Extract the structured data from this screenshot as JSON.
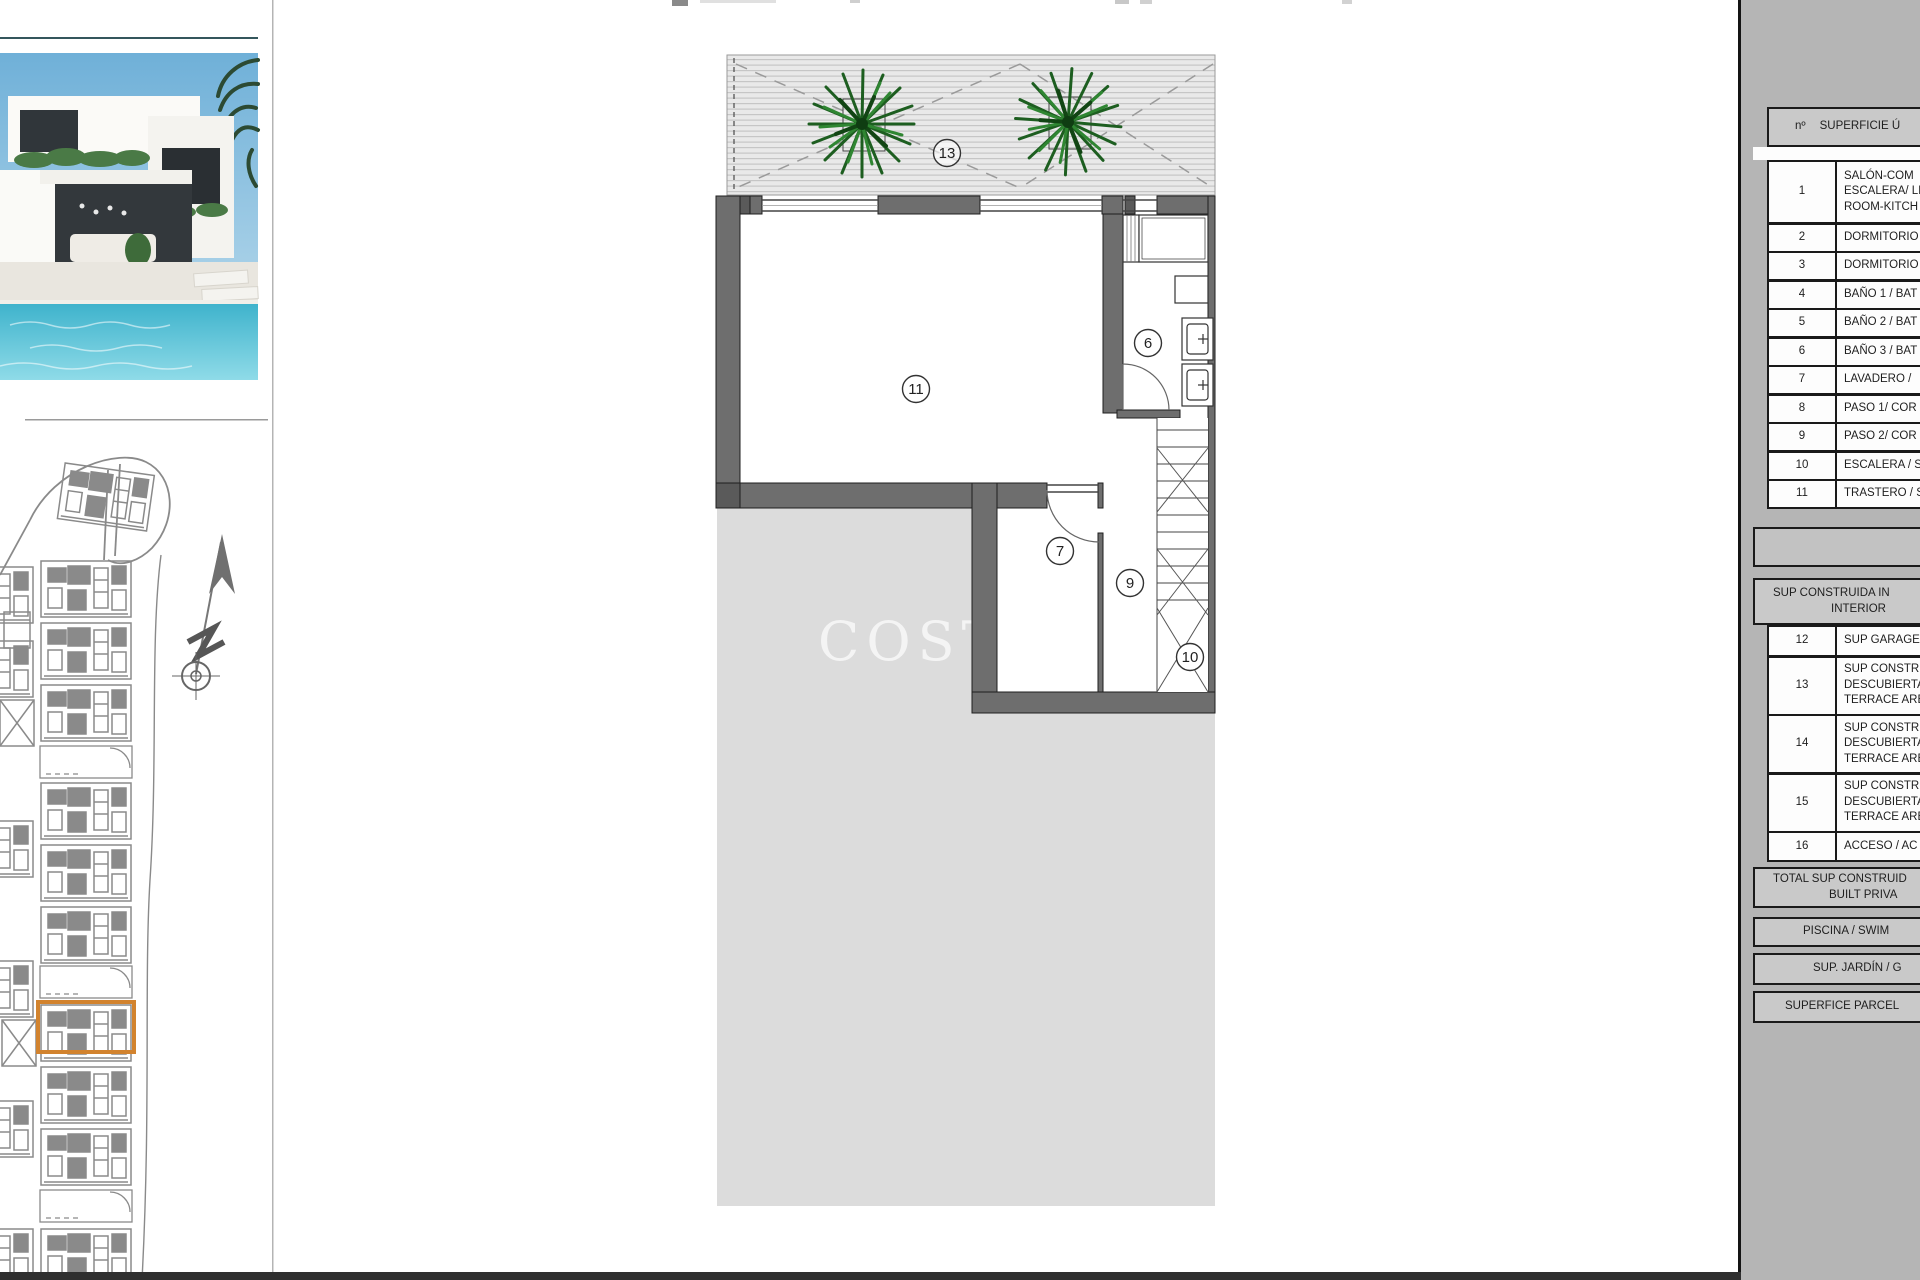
{
  "watermark": {
    "main": "COSTA",
    "tail": "s"
  },
  "floor_plan": {
    "labels": {
      "terrace": "13",
      "storage": "11",
      "bath": "6",
      "laundry": "7",
      "hall": "9",
      "stairs": "10"
    }
  },
  "right_panel": {
    "header": {
      "num": "nº",
      "title": "SUPERFICIE Ú"
    },
    "rows": [
      {
        "n": "1",
        "lines": [
          "SALÓN-COM",
          "ESCALERA/ LI",
          "ROOM-KITCH"
        ]
      },
      {
        "n": "2",
        "lines": [
          "DORMITORIO"
        ]
      },
      {
        "n": "3",
        "lines": [
          "DORMITORIO"
        ]
      },
      {
        "n": "4",
        "lines": [
          "BAÑO 1 / BAT"
        ]
      },
      {
        "n": "5",
        "lines": [
          "BAÑO 2 / BAT"
        ]
      },
      {
        "n": "6",
        "lines": [
          "BAÑO 3 / BAT"
        ]
      },
      {
        "n": "7",
        "lines": [
          "LAVADERO /"
        ]
      },
      {
        "n": "8",
        "lines": [
          "PASO 1/ COR"
        ]
      },
      {
        "n": "9",
        "lines": [
          "PASO 2/ COR"
        ]
      },
      {
        "n": "10",
        "lines": [
          "ESCALERA / S"
        ]
      },
      {
        "n": "11",
        "lines": [
          "TRASTERO / S"
        ]
      }
    ],
    "section2_header": {
      "line1": "SUP CONSTRUIDA IN",
      "line2": "INTERIOR"
    },
    "rows2": [
      {
        "n": "12",
        "lines": [
          "SUP GARAGE,"
        ]
      },
      {
        "n": "13",
        "lines": [
          "SUP CONSTRU",
          "DESCUBIERTA",
          "TERRACE ARE"
        ]
      },
      {
        "n": "14",
        "lines": [
          "SUP CONSTRU",
          "DESCUBIERTA",
          "TERRACE ARE"
        ]
      },
      {
        "n": "15",
        "lines": [
          "SUP CONSTRU",
          "DESCUBIERTA",
          "TERRACE ARE"
        ]
      },
      {
        "n": "16",
        "lines": [
          "ACCESO / AC"
        ]
      }
    ],
    "total_band": {
      "line1": "TOTAL SUP CONSTRUID",
      "line2": "BUILT PRIVA"
    },
    "pool_band": "PISCINA / SWIM",
    "garden_band": "SUP. JARDÍN / G",
    "parcel_band": "SUPERFICE PARCEL"
  },
  "colors": {
    "wall": "#6e6e6e",
    "parcel": "#dcdcdc",
    "deck": "#e9e9e9",
    "siteplan": "#8a8a8a",
    "highlight": "#d2832e",
    "panel_bg": "#b5b5b5"
  }
}
